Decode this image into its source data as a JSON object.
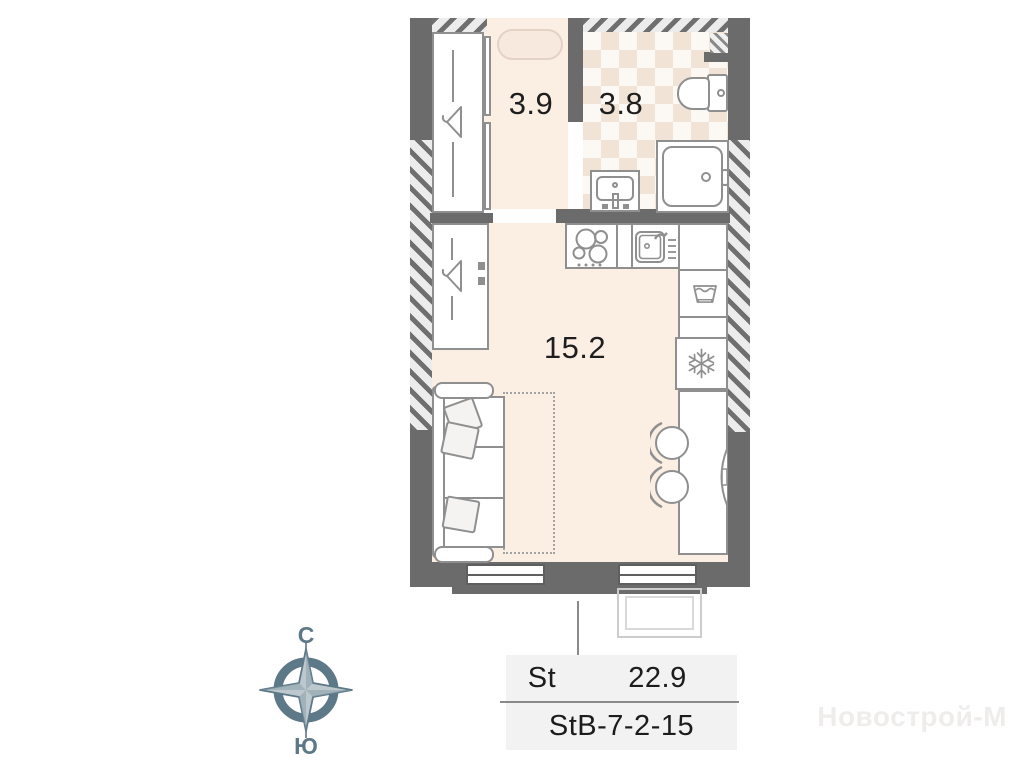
{
  "plan": {
    "rooms": [
      {
        "name": "hallway",
        "area": "3.9"
      },
      {
        "name": "bathroom",
        "area": "3.8"
      },
      {
        "name": "living-room",
        "area": "15.2"
      }
    ]
  },
  "info_table": {
    "type_label": "St",
    "total_area": "22.9",
    "unit_code": "StB-7-2-15"
  },
  "compass": {
    "north": "С",
    "south": "Ю"
  },
  "watermark": {
    "text": "Новострой-М"
  },
  "colors": {
    "wall": "#6b6b6b",
    "floor": "#fbeee3",
    "tile_accent": "#f2e3d7",
    "furniture_stroke": "#8f8f8f",
    "table_bg": "#f2f2f2",
    "compass": "#5d7886"
  },
  "icons": [
    "hanger-icon",
    "stove-icon",
    "kitchen-sink-icon",
    "washing-machine-icon",
    "snowflake-icon",
    "tv-icon",
    "chair-icon",
    "toilet-icon",
    "shower-icon",
    "bathroom-sink-icon",
    "compass-rose-icon"
  ]
}
